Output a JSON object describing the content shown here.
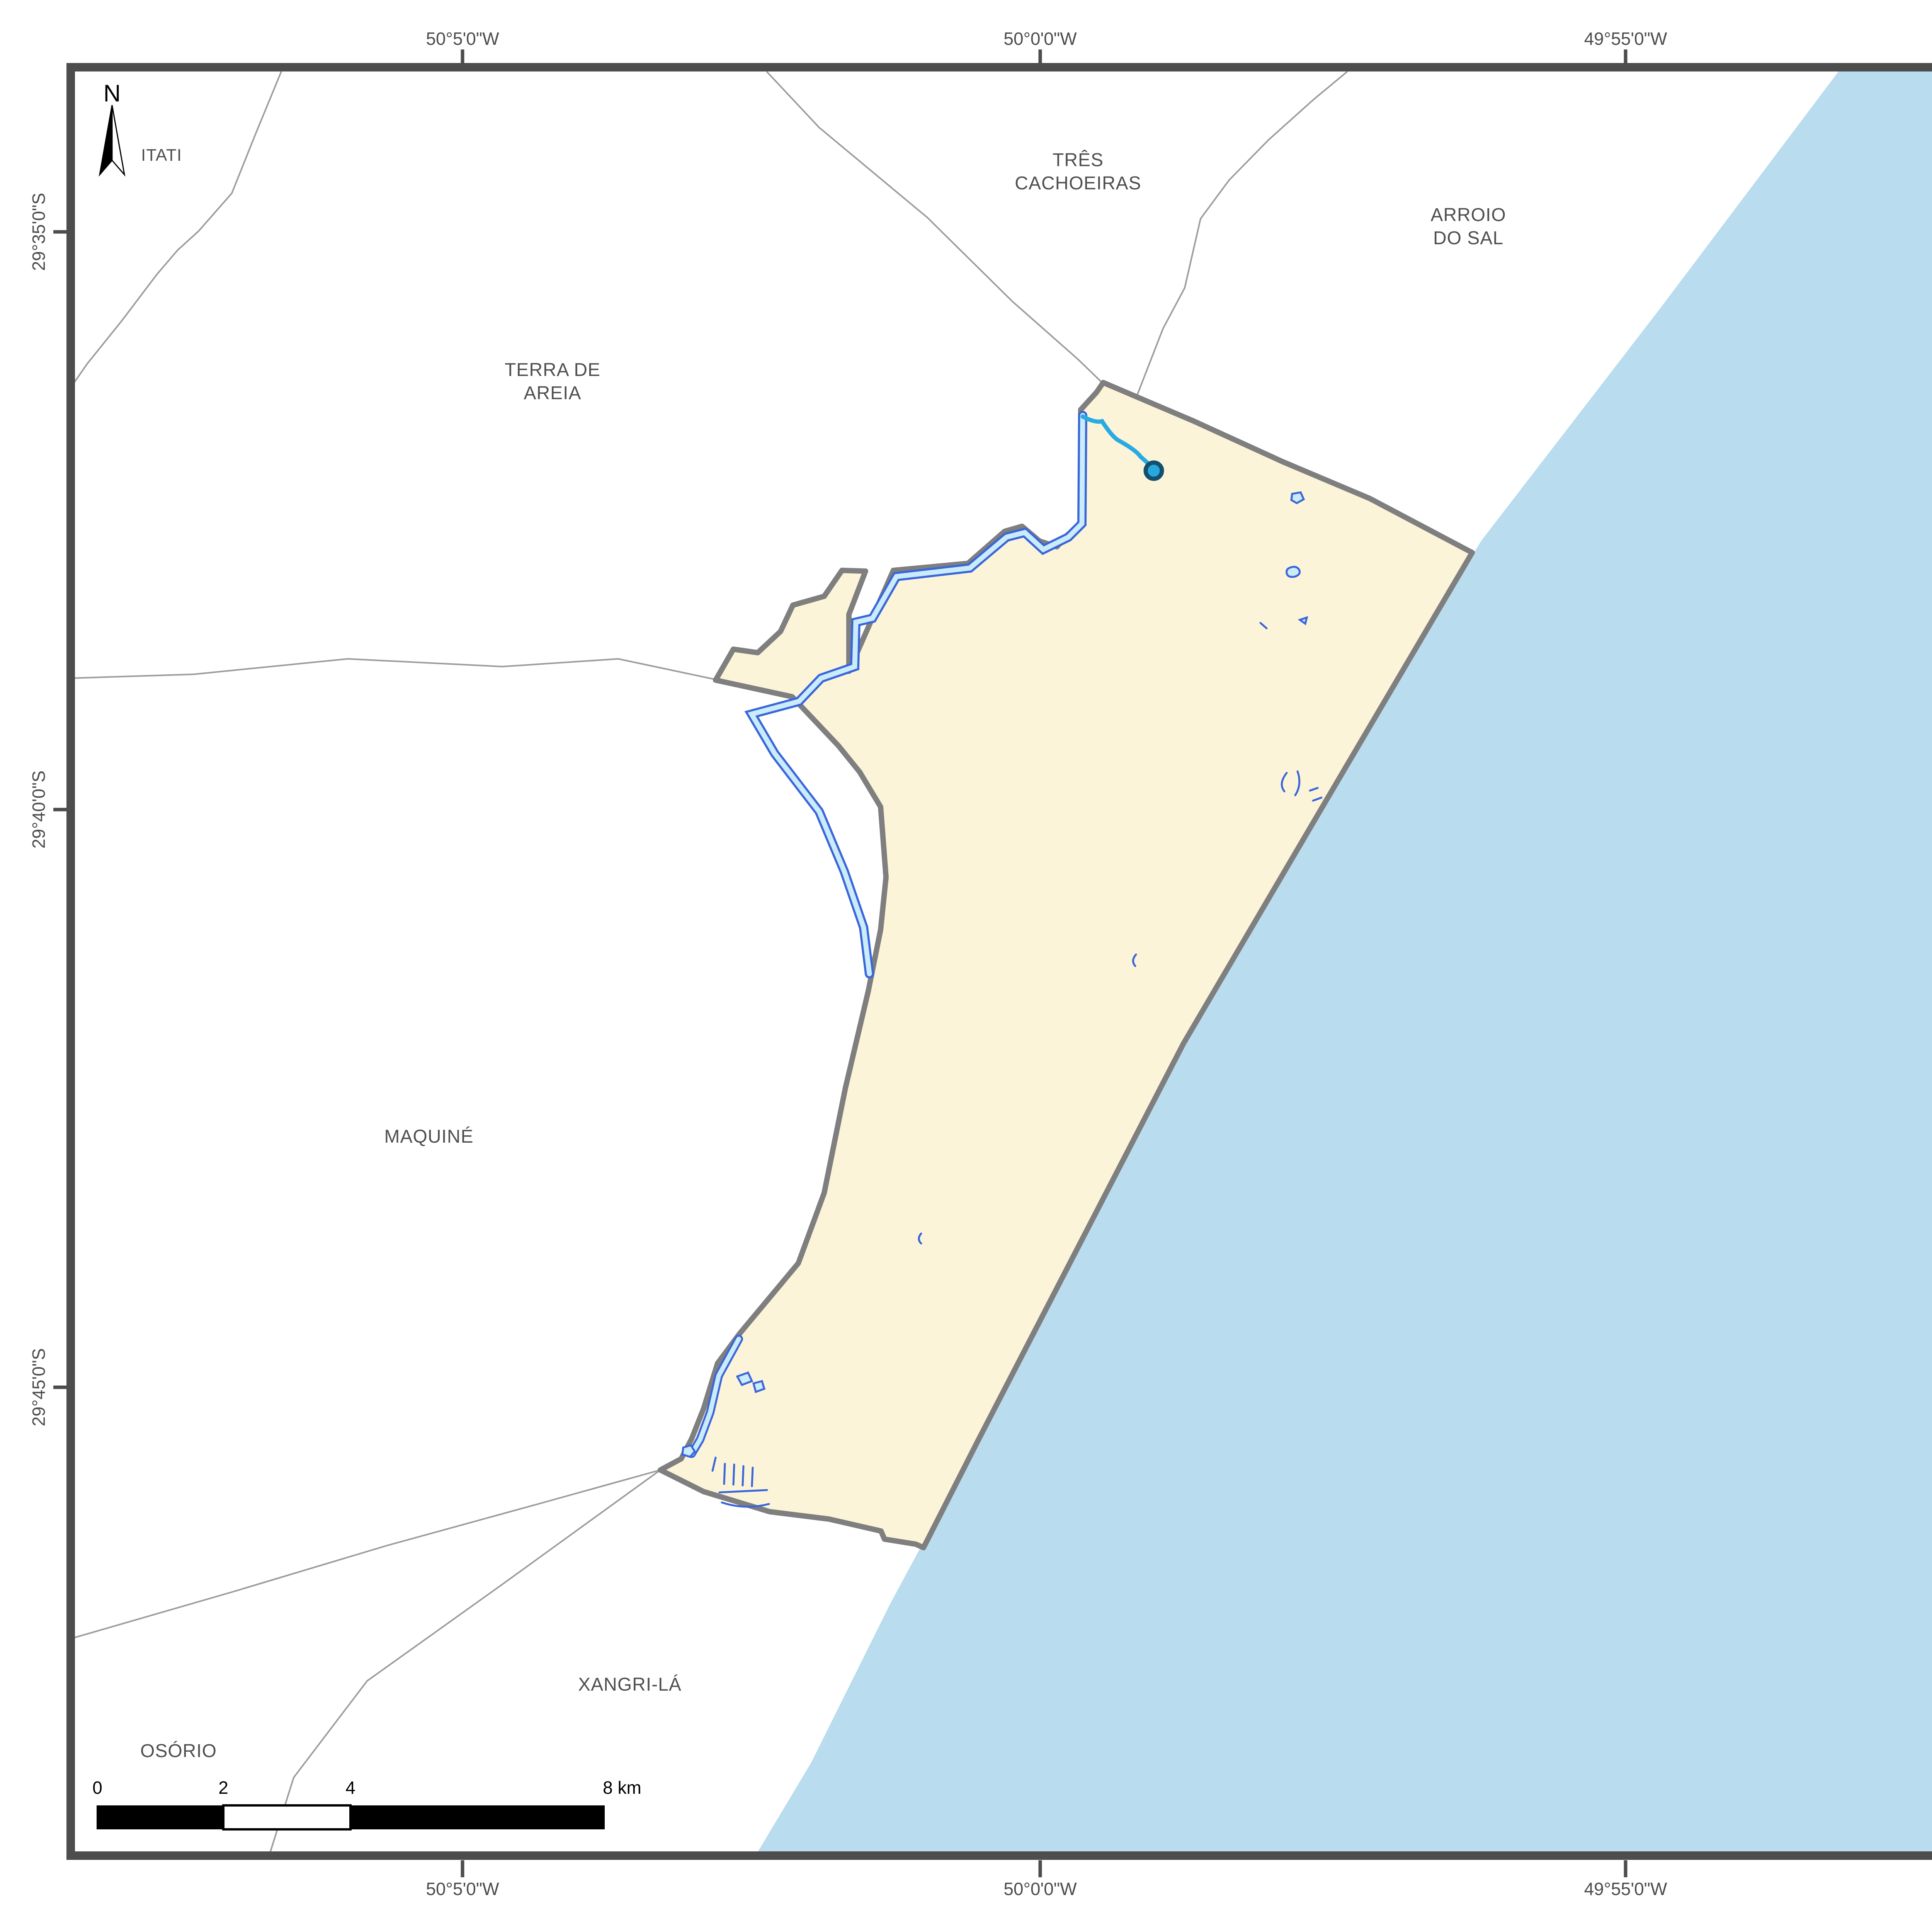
{
  "title_panel": {
    "title": "PROJETO DE APOIO À\nIMPLANTAÇÃO DO CAR",
    "municipality": "CAPÃO DA CANOA - RS",
    "theme": "Hidrografia"
  },
  "legend": {
    "header": "Legenda",
    "items": [
      {
        "label": "Limite Municipal"
      },
      {
        "label": "Nascentes"
      },
      {
        "label": "Rios (até 10m de largura)"
      },
      {
        "label": "Rios (> 10m de largura)\ne Massas d'água"
      }
    ],
    "total_length": "Comprimento total: 6 km"
  },
  "location": {
    "header": "Localização do Município",
    "state_label": "SC"
  },
  "source": {
    "header": "Fonte de Dados",
    "line1": "Imagens Rapideye - Ano 2014",
    "line2": "Sistema de Coordenadas Geográficas\nDatum SIRGAS 2000"
  },
  "logo": {
    "text": "fbds"
  },
  "north": {
    "label": "N"
  },
  "map_labels": [
    {
      "text": "ITATI"
    },
    {
      "text": "TRÊS\nCACHOEIRAS"
    },
    {
      "text": "ARROIO\nDO SAL"
    },
    {
      "text": "TERRA DE\nAREIA"
    },
    {
      "text": "MAQUINÉ"
    },
    {
      "text": "XANGRI-LÁ"
    },
    {
      "text": "OSÓRIO"
    }
  ],
  "axes": {
    "top": [
      {
        "label": "50°5'0\"W"
      },
      {
        "label": "50°0'0\"W"
      },
      {
        "label": "49°55'0\"W"
      }
    ],
    "bottom": [
      {
        "label": "50°5'0\"W"
      },
      {
        "label": "50°0'0\"W"
      },
      {
        "label": "49°55'0\"W"
      }
    ],
    "left": [
      {
        "label": "29°35'0\"S"
      },
      {
        "label": "29°40'0\"S"
      },
      {
        "label": "29°45'0\"S"
      }
    ]
  },
  "scalebar": {
    "labels": [
      {
        "t": "0"
      },
      {
        "t": "2"
      },
      {
        "t": "4"
      },
      {
        "t": "8 km"
      }
    ]
  },
  "colors": {
    "ocean": "#B9DCEE",
    "municipality_fill": "#FCF4D9",
    "municipality_border": "#7F7F7F",
    "boundary_gray": "#9C9C9C",
    "frame": "#4D4D4D",
    "river_small": "#29ABE2",
    "river_large_fill": "#C9EBFA",
    "river_large_stroke": "#3A66DB",
    "nascente_fill": "#29A8DC",
    "nascente_ring": "#134F70",
    "inset_bg": "#7F7F7F",
    "inset_sc": "#DCDCDC",
    "marker_red": "#FF0000",
    "logo_green": "#2DB200",
    "logo_gold": "#E8B83A",
    "logo_text": "#7A7268"
  }
}
